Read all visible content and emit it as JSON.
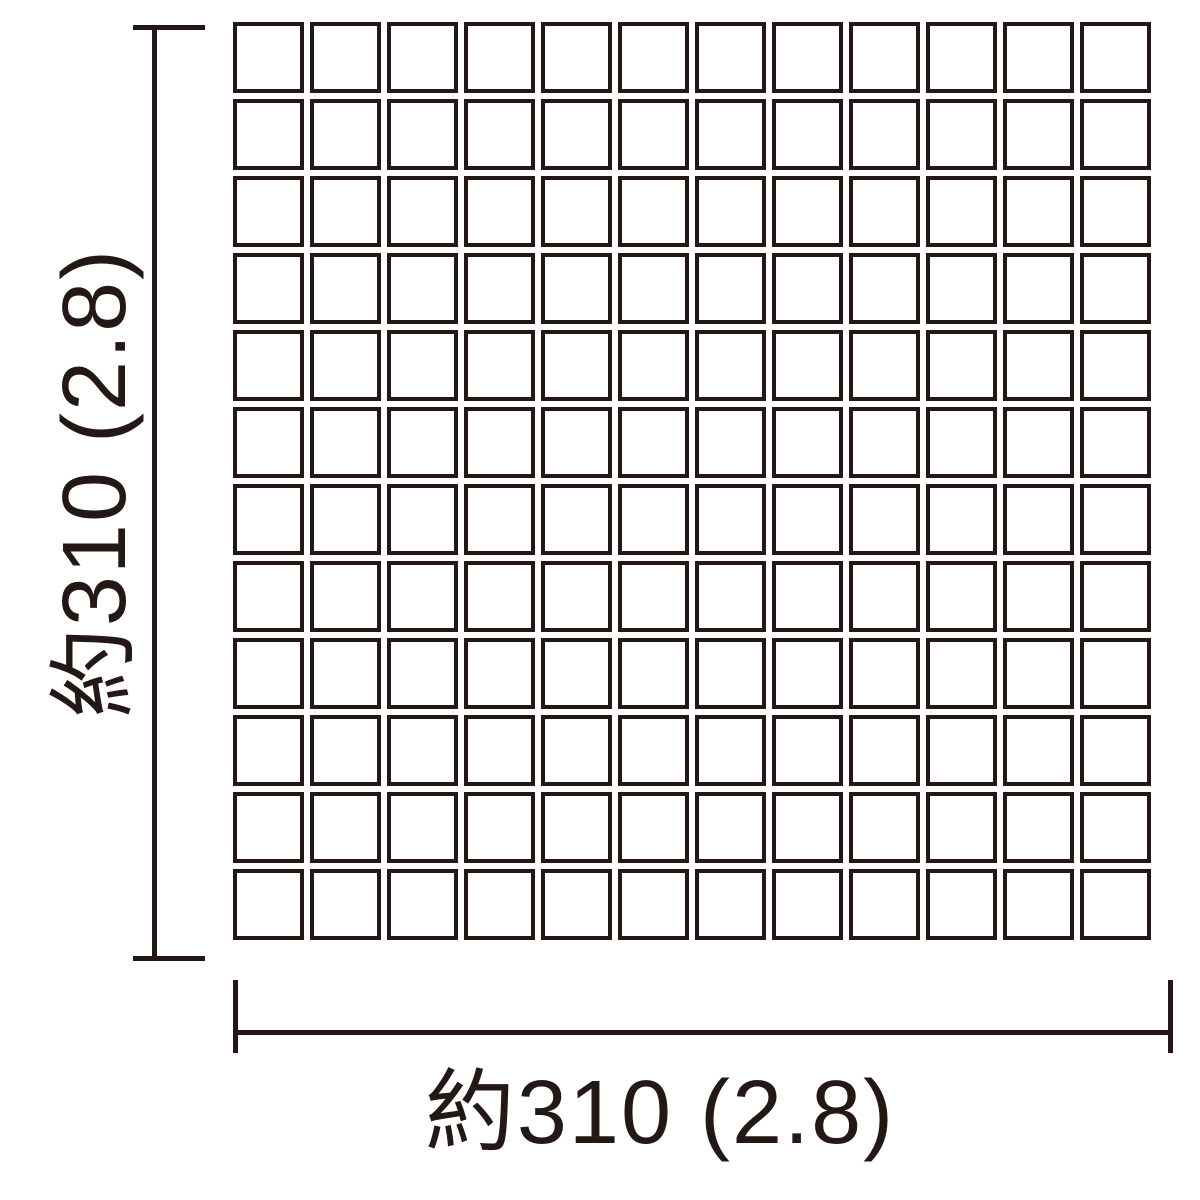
{
  "diagram": {
    "colors": {
      "ink": "#231815",
      "background": "#ffffff",
      "tile_fill": "#ffffff"
    },
    "grid": {
      "rows": 12,
      "cols": 12
    },
    "width_dimension": {
      "label": "約310 (2.8)"
    },
    "height_dimension": {
      "label": "約310 (2.8)"
    }
  }
}
